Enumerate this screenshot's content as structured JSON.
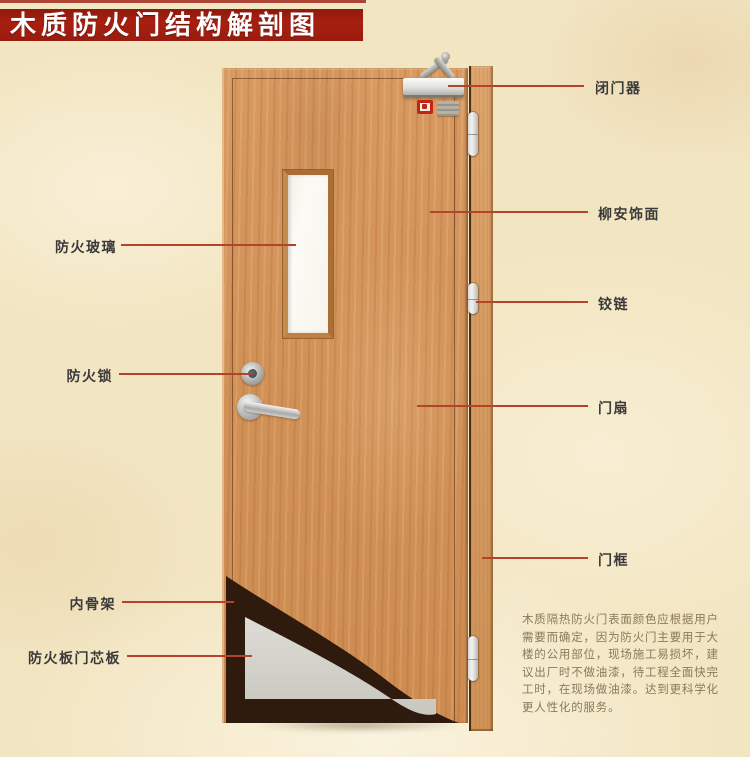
{
  "title": "木质防火门结构解剖图",
  "labels": {
    "fire_glass": "防火玻璃",
    "fire_lock": "防火锁",
    "inner_frame": "内骨架",
    "fire_board_core": "防火板门芯板",
    "door_closer": "闭门器",
    "lauan_veneer": "柳安饰面",
    "hinge": "铰链",
    "door_leaf": "门扇",
    "door_frame": "门框"
  },
  "description": {
    "lines": [
      "木质隔热防火门表面颜色应根据用户",
      "需要而确定，因为防火门主要用于大",
      "楼的公用部位，现场施工易损坏，建",
      "议出厂时不做油漆，待工程全面快完",
      "工时，在现场做油漆。达到更科学化",
      "更人性化的服务。"
    ]
  },
  "colors": {
    "banner_red": "#a11d12",
    "background_parchment": "#f2e5c2",
    "leader_line": "#b4432b",
    "wood_veneer": "#d19157",
    "core_gray": "#d8d7d0",
    "skeleton_dark": "#2e1b0d"
  }
}
